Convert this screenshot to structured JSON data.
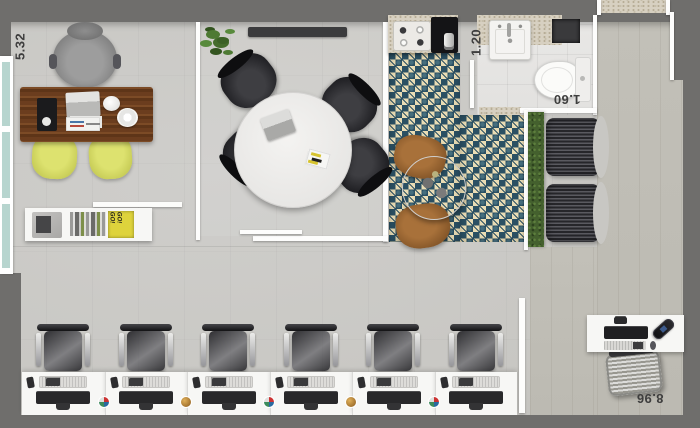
{
  "dimensions": {
    "left_wall": "5.32",
    "kitchen_pass": "1.20",
    "bathroom": "1.60",
    "bottom_right": "8.96"
  },
  "decor": {
    "book_stack_text": "GO! GO!"
  },
  "workstations": {
    "count": 6
  },
  "colors": {
    "wall_dark": "#6f6e6c",
    "floor_concrete": "#c8c7c3",
    "floor_wood": "#c2c0b8",
    "tile_navy": "#2b5063",
    "tile_cream": "#e9dcb4",
    "chair_yellow": "#ccd15c",
    "desk_wood_dark": "#5e3518",
    "desk_wood_light": "#7c4b26",
    "hedge_green": "#44602e",
    "furniture_white": "#f7f7f5",
    "granite": "#d7d0c1",
    "dark_furniture": "#2e2e30",
    "window_glass": "#b7d5cf"
  }
}
